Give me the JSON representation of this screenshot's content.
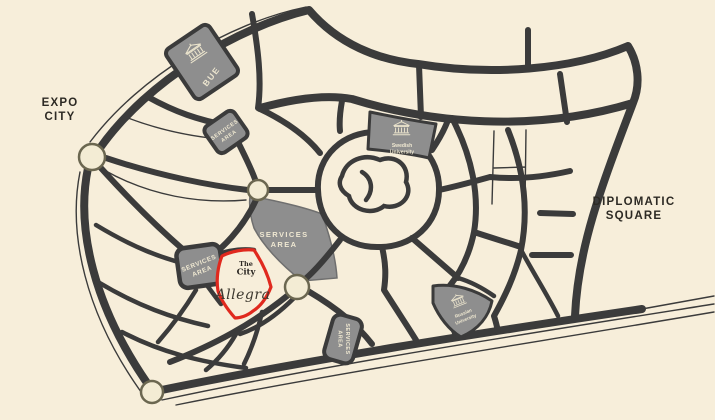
{
  "map": {
    "title": "masterplan-map",
    "colors": {
      "background": "#f7eeda",
      "road": "#3b3b3b",
      "area_fill": "#8e8e8e",
      "area_text": "#f0e9d2",
      "dark_label": "#2d2a24",
      "highlight_outline": "#e0291e",
      "roundabout_ring": "#6b6750",
      "roundabout_fill": "#f3ecd4"
    },
    "icons": {
      "university_building": "building-columns-icon"
    },
    "labels": {
      "expo_city": {
        "line1": "EXPO",
        "line2": "CITY"
      },
      "diplomatic_square": {
        "line1": "DIPLOMATIC",
        "line2": "SQUARE"
      },
      "bue": "BUE",
      "swedish_university": {
        "line1": "Swedish",
        "line2": "University"
      },
      "russian_university": {
        "line1": "Russian",
        "line2": "University"
      },
      "services_area": {
        "line1": "SERVICES",
        "line2": "AREA"
      },
      "project": {
        "brand_line1": "The",
        "brand_line2": "City",
        "name": "Allegra"
      }
    }
  }
}
